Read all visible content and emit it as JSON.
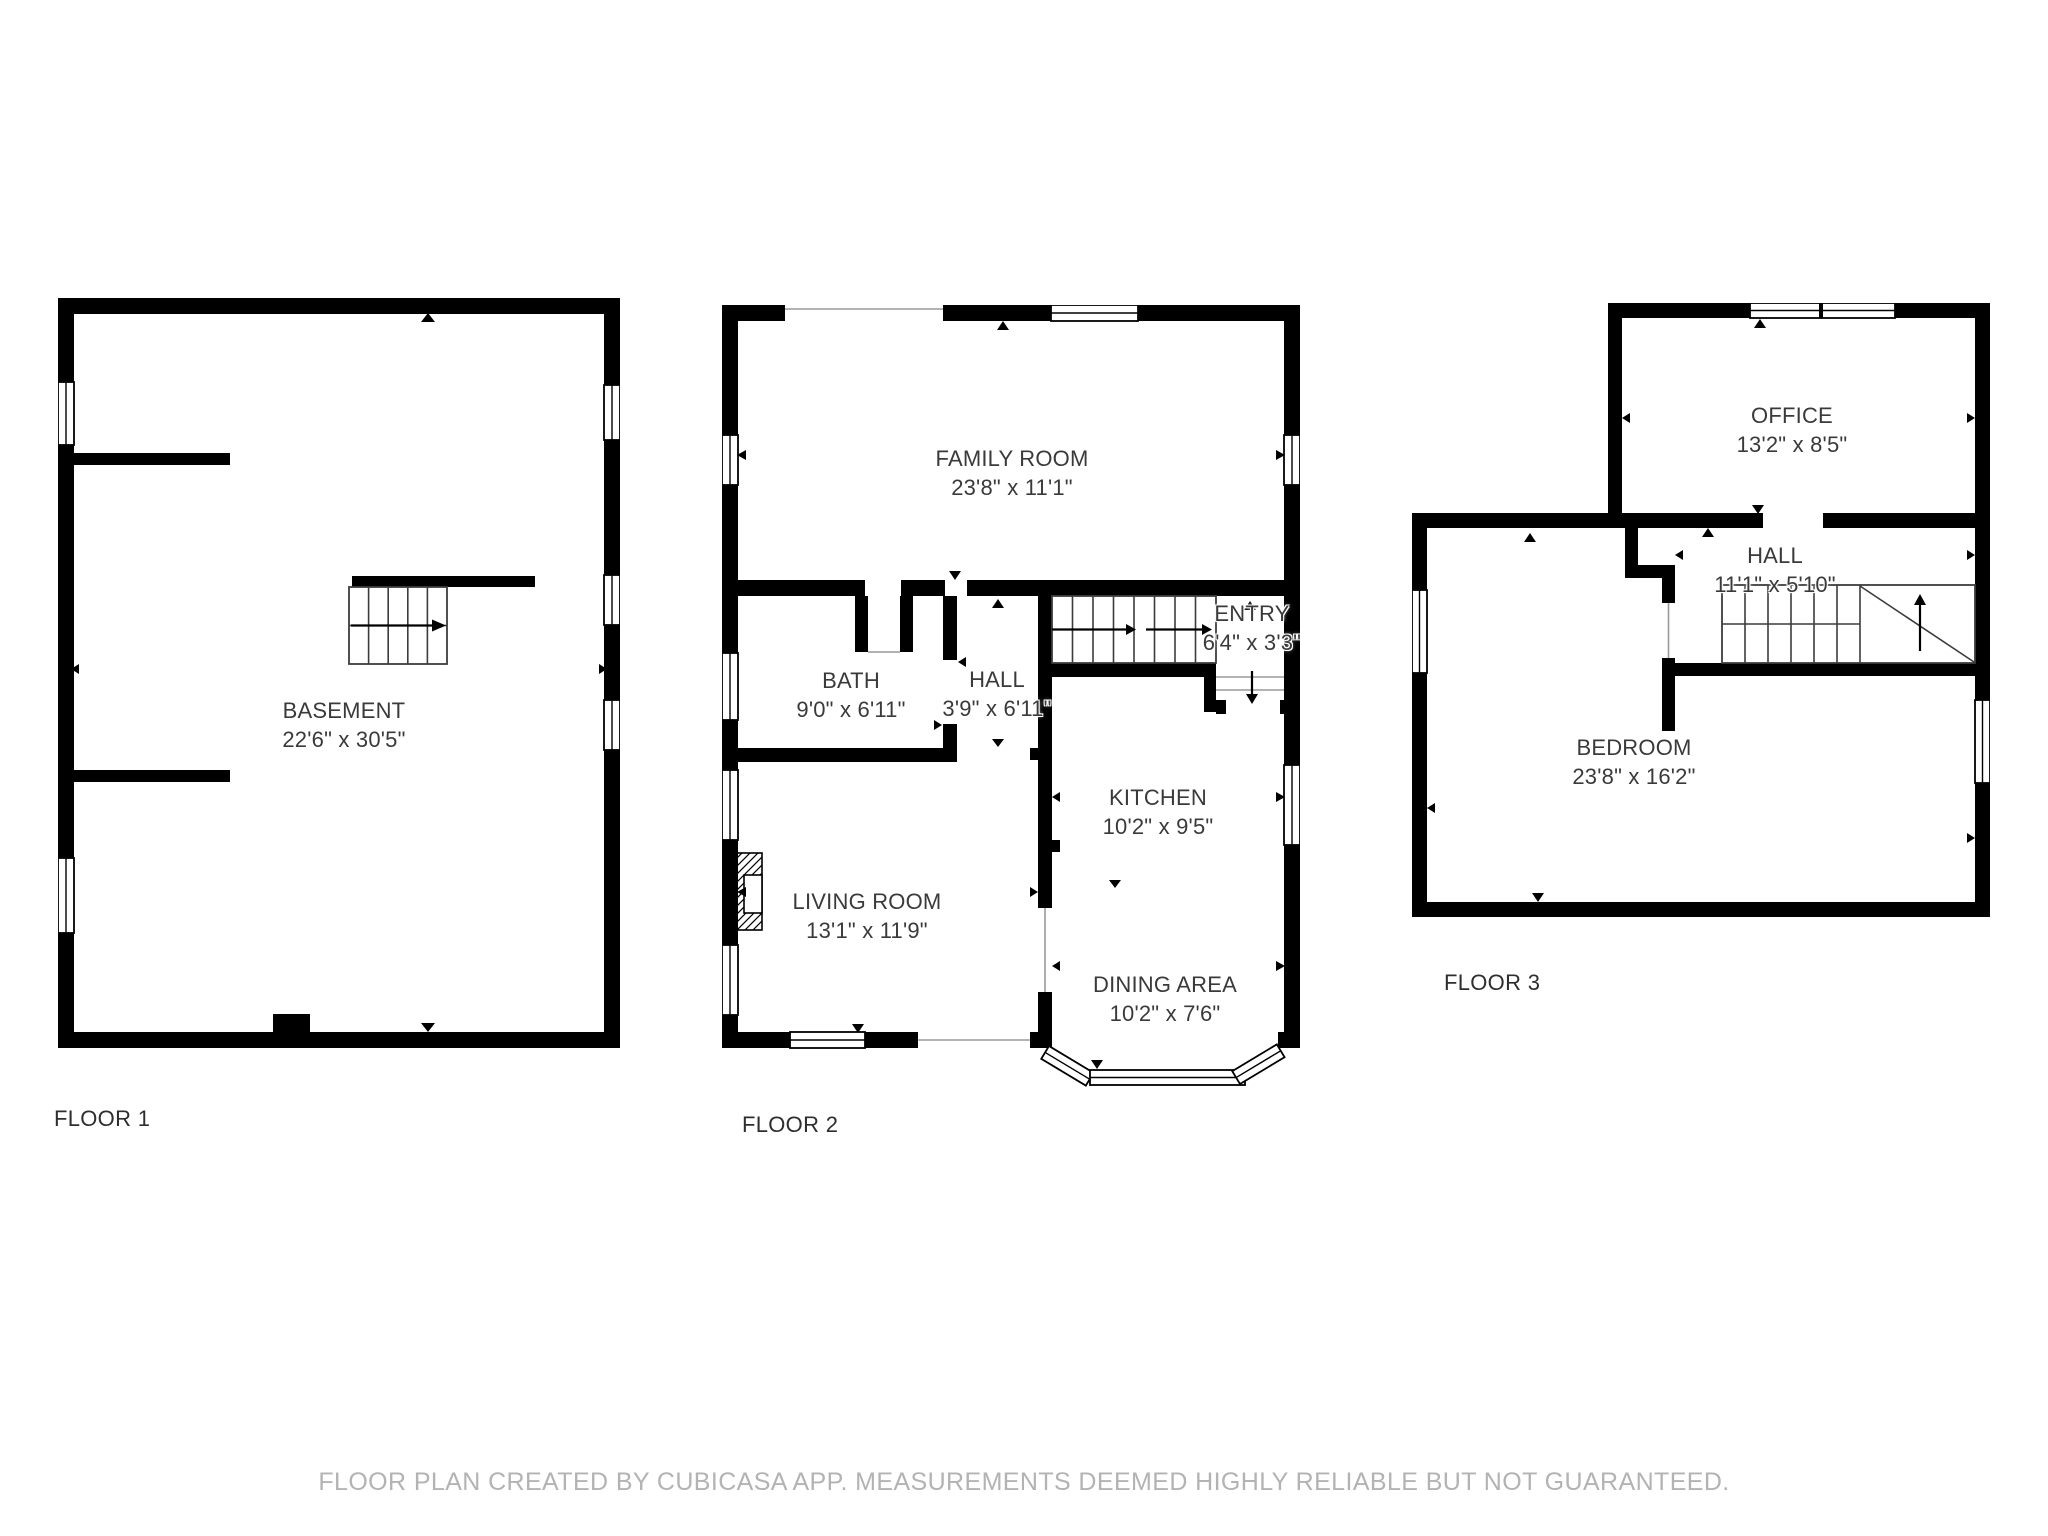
{
  "floors": [
    {
      "label": "FLOOR 1",
      "rooms": [
        {
          "name": "BASEMENT",
          "dims": "22'6\" x 30'5\""
        }
      ]
    },
    {
      "label": "FLOOR 2",
      "rooms": [
        {
          "name": "FAMILY ROOM",
          "dims": "23'8\" x 11'1\""
        },
        {
          "name": "BATH",
          "dims": "9'0\" x 6'11\""
        },
        {
          "name": "HALL",
          "dims": "3'9\" x 6'11\""
        },
        {
          "name": "ENTRY",
          "dims": "6'4\" x 3'3\""
        },
        {
          "name": "KITCHEN",
          "dims": "10'2\" x 9'5\""
        },
        {
          "name": "LIVING ROOM",
          "dims": "13'1\" x 11'9\""
        },
        {
          "name": "DINING AREA",
          "dims": "10'2\" x 7'6\""
        }
      ]
    },
    {
      "label": "FLOOR 3",
      "rooms": [
        {
          "name": "OFFICE",
          "dims": "13'2\" x 8'5\""
        },
        {
          "name": "HALL",
          "dims": "11'1\" x 5'10\""
        },
        {
          "name": "BEDROOM",
          "dims": "23'8\" x 16'2\""
        }
      ]
    }
  ],
  "footer": {
    "disclaimer": "FLOOR PLAN CREATED BY CUBICASA APP. MEASUREMENTS DEEMED HIGHLY RELIABLE BUT NOT GUARANTEED."
  },
  "colors": {
    "wall": "#000000",
    "room_text": "#3a3a3a",
    "floor_label": "#2e2e2e",
    "footer_text": "#b3b3b3",
    "background": "#ffffff"
  }
}
